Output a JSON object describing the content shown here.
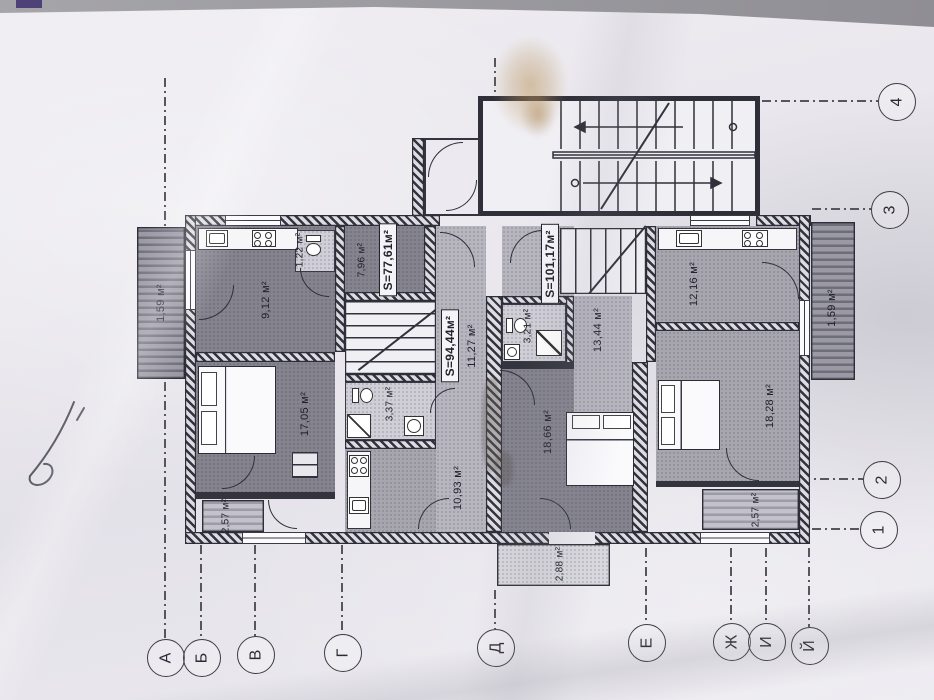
{
  "scene": {
    "description": "Photographed architectural floor plan on paper, rotated 90 degrees",
    "paper_color": "#eceaef",
    "ink_color": "#2e2e38",
    "handwritten_note": "Ч3"
  },
  "plan": {
    "apartments": [
      {
        "name": "left-apartment",
        "area_label": "S=77,61м²",
        "hall_label": "7,96 м²"
      },
      {
        "name": "middle-apartment",
        "area_label": "S=94,44м²"
      },
      {
        "name": "right-apartment",
        "area_label": "S=101,17м²"
      }
    ],
    "rooms": [
      {
        "name": "balcony-left",
        "label": "1,59 м²"
      },
      {
        "name": "kitchen-living-left",
        "label": "9,12 м²"
      },
      {
        "name": "wc-left",
        "label": "1,22 м²"
      },
      {
        "name": "bedroom-left",
        "label": "17,05 м²"
      },
      {
        "name": "loggia-bottom-left",
        "label": "2,57 м²"
      },
      {
        "name": "bathroom-left",
        "label": "3,37 м²"
      },
      {
        "name": "kitchen-middle",
        "label": "10,93 м²"
      },
      {
        "name": "corridor-middle",
        "label": "11,27 м²"
      },
      {
        "name": "living-middle",
        "label": "18,66 м²"
      },
      {
        "name": "entrance-porch",
        "label": "2,88 м²"
      },
      {
        "name": "bathroom-right",
        "label": "3,21 м²"
      },
      {
        "name": "corridor-right",
        "label": "13,44 м²"
      },
      {
        "name": "kitchen-right",
        "label": "12,16 м²"
      },
      {
        "name": "balcony-right",
        "label": "1,59 м²"
      },
      {
        "name": "bedroom-right",
        "label": "18,28 м²"
      },
      {
        "name": "loggia-bottom-right",
        "label": "2,57 м²"
      }
    ],
    "axes": {
      "letters": [
        "А",
        "Б",
        "В",
        "Г",
        "Д",
        "Е",
        "Ж",
        "И",
        "Й"
      ],
      "numbers": [
        "1",
        "2",
        "3",
        "4"
      ]
    }
  }
}
